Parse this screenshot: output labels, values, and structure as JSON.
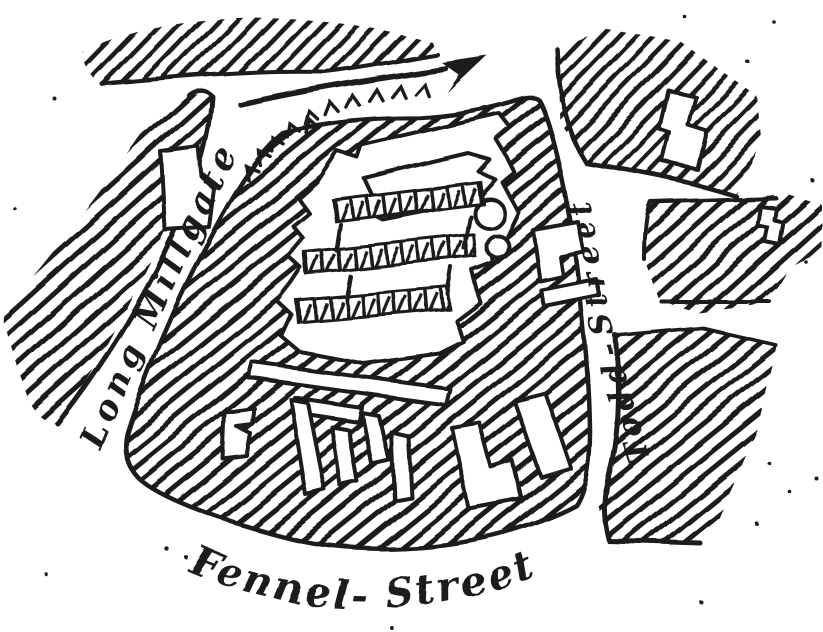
{
  "map": {
    "paper_color": "#ffffff",
    "ink_color": "#1a1a1a",
    "streets": [
      {
        "id": "long-millgate",
        "label": "Long Millgate",
        "orientation": "diagonal label running up the north-west street"
      },
      {
        "id": "todd-street",
        "label": "Todd-Street",
        "orientation": "vertical label read bottom-to-top along the eastern street"
      },
      {
        "id": "fennel-street",
        "label": "Fennel- Street",
        "orientation": "curved label along the bottom street"
      }
    ],
    "symbols": {
      "route_arrow": "hand-drawn arrow curving toward the north-east",
      "slope_chevrons": "row of small chevron ticks along the road south of the arrow"
    }
  }
}
